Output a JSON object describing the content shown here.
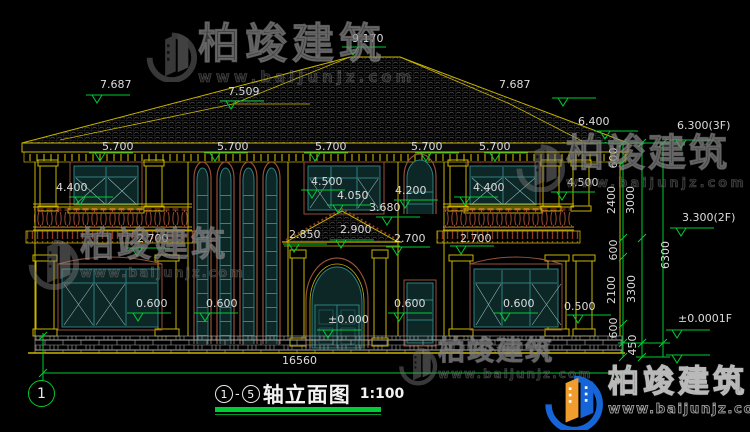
{
  "title": {
    "from": "1",
    "dash": "-",
    "to": "5",
    "text": "轴立面图",
    "scale": "1:100"
  },
  "axis": {
    "label": "1"
  },
  "total_width": "16560",
  "watermark": {
    "cn": "柏竣建筑",
    "url": "www.baijunjz.com"
  },
  "logo": {
    "cn": "柏竣建筑",
    "url": "www.baijunjz.com"
  },
  "colors": {
    "background": "#000000",
    "cad_yellow": "#c9b400",
    "cad_green": "#00cc33",
    "frame_teal": "#2e8080",
    "arch_brown": "#96503a",
    "dim_text": "#dcdcdc",
    "logo_blue": "#1565d8",
    "logo_orange": "#f09d2e"
  },
  "labels": [
    {
      "t": "9.170",
      "x": 352,
      "y": 33
    },
    {
      "t": "7.687",
      "x": 100,
      "y": 79
    },
    {
      "t": "7.509",
      "x": 228,
      "y": 86
    },
    {
      "t": "7.687",
      "x": 499,
      "y": 79
    },
    {
      "t": "6.400",
      "x": 578,
      "y": 116
    },
    {
      "t": "6.300(3F)",
      "x": 677,
      "y": 120
    },
    {
      "t": "5.700",
      "x": 102,
      "y": 141
    },
    {
      "t": "5.700",
      "x": 217,
      "y": 141
    },
    {
      "t": "5.700",
      "x": 315,
      "y": 141
    },
    {
      "t": "5.700",
      "x": 411,
      "y": 141
    },
    {
      "t": "5.700",
      "x": 479,
      "y": 141
    },
    {
      "t": "4.400",
      "x": 56,
      "y": 182
    },
    {
      "t": "4.400",
      "x": 473,
      "y": 182
    },
    {
      "t": "4.500",
      "x": 311,
      "y": 176
    },
    {
      "t": "4.500",
      "x": 567,
      "y": 177
    },
    {
      "t": "4.050",
      "x": 337,
      "y": 190
    },
    {
      "t": "4.200",
      "x": 395,
      "y": 185
    },
    {
      "t": "3.680",
      "x": 369,
      "y": 202
    },
    {
      "t": "2.850",
      "x": 289,
      "y": 229
    },
    {
      "t": "2.900",
      "x": 340,
      "y": 224
    },
    {
      "t": "2.700",
      "x": 137,
      "y": 233
    },
    {
      "t": "2.700",
      "x": 394,
      "y": 233
    },
    {
      "t": "2.700",
      "x": 460,
      "y": 233
    },
    {
      "t": "3.300(2F)",
      "x": 682,
      "y": 212
    },
    {
      "t": "0.600",
      "x": 136,
      "y": 298
    },
    {
      "t": "0.600",
      "x": 206,
      "y": 298
    },
    {
      "t": "0.600",
      "x": 394,
      "y": 298
    },
    {
      "t": "0.600",
      "x": 503,
      "y": 298
    },
    {
      "t": "0.500",
      "x": 564,
      "y": 301
    },
    {
      "t": "±0.000",
      "x": 328,
      "y": 314
    },
    {
      "t": "±0.0001F",
      "x": 678,
      "y": 313
    },
    {
      "t": "16560",
      "x": 282,
      "y": 355
    },
    {
      "t": "600",
      "x": 614,
      "y": 158,
      "r": 1
    },
    {
      "t": "2400",
      "x": 612,
      "y": 200,
      "r": 1
    },
    {
      "t": "3000",
      "x": 631,
      "y": 200,
      "r": 1
    },
    {
      "t": "600",
      "x": 614,
      "y": 250,
      "r": 1
    },
    {
      "t": "2100",
      "x": 612,
      "y": 290,
      "r": 1
    },
    {
      "t": "3300",
      "x": 632,
      "y": 289,
      "r": 1
    },
    {
      "t": "600",
      "x": 614,
      "y": 328,
      "r": 1
    },
    {
      "t": "450",
      "x": 633,
      "y": 345,
      "r": 1
    },
    {
      "t": "6300",
      "x": 666,
      "y": 255,
      "r": 1
    }
  ],
  "markers": [
    [
      348,
      47
    ],
    [
      92,
      95
    ],
    [
      226,
      101
    ],
    [
      558,
      98
    ],
    [
      600,
      131
    ],
    [
      676,
      140
    ],
    [
      95,
      153
    ],
    [
      210,
      153
    ],
    [
      310,
      153
    ],
    [
      421,
      153
    ],
    [
      490,
      153
    ],
    [
      75,
      197
    ],
    [
      460,
      197
    ],
    [
      307,
      190
    ],
    [
      557,
      192
    ],
    [
      333,
      205
    ],
    [
      400,
      200
    ],
    [
      382,
      217
    ],
    [
      289,
      244
    ],
    [
      336,
      240
    ],
    [
      132,
      248
    ],
    [
      392,
      247
    ],
    [
      456,
      246
    ],
    [
      676,
      228
    ],
    [
      133,
      313
    ],
    [
      200,
      313
    ],
    [
      394,
      313
    ],
    [
      500,
      313
    ],
    [
      573,
      315
    ],
    [
      323,
      330
    ],
    [
      672,
      330
    ],
    [
      672,
      355
    ]
  ]
}
